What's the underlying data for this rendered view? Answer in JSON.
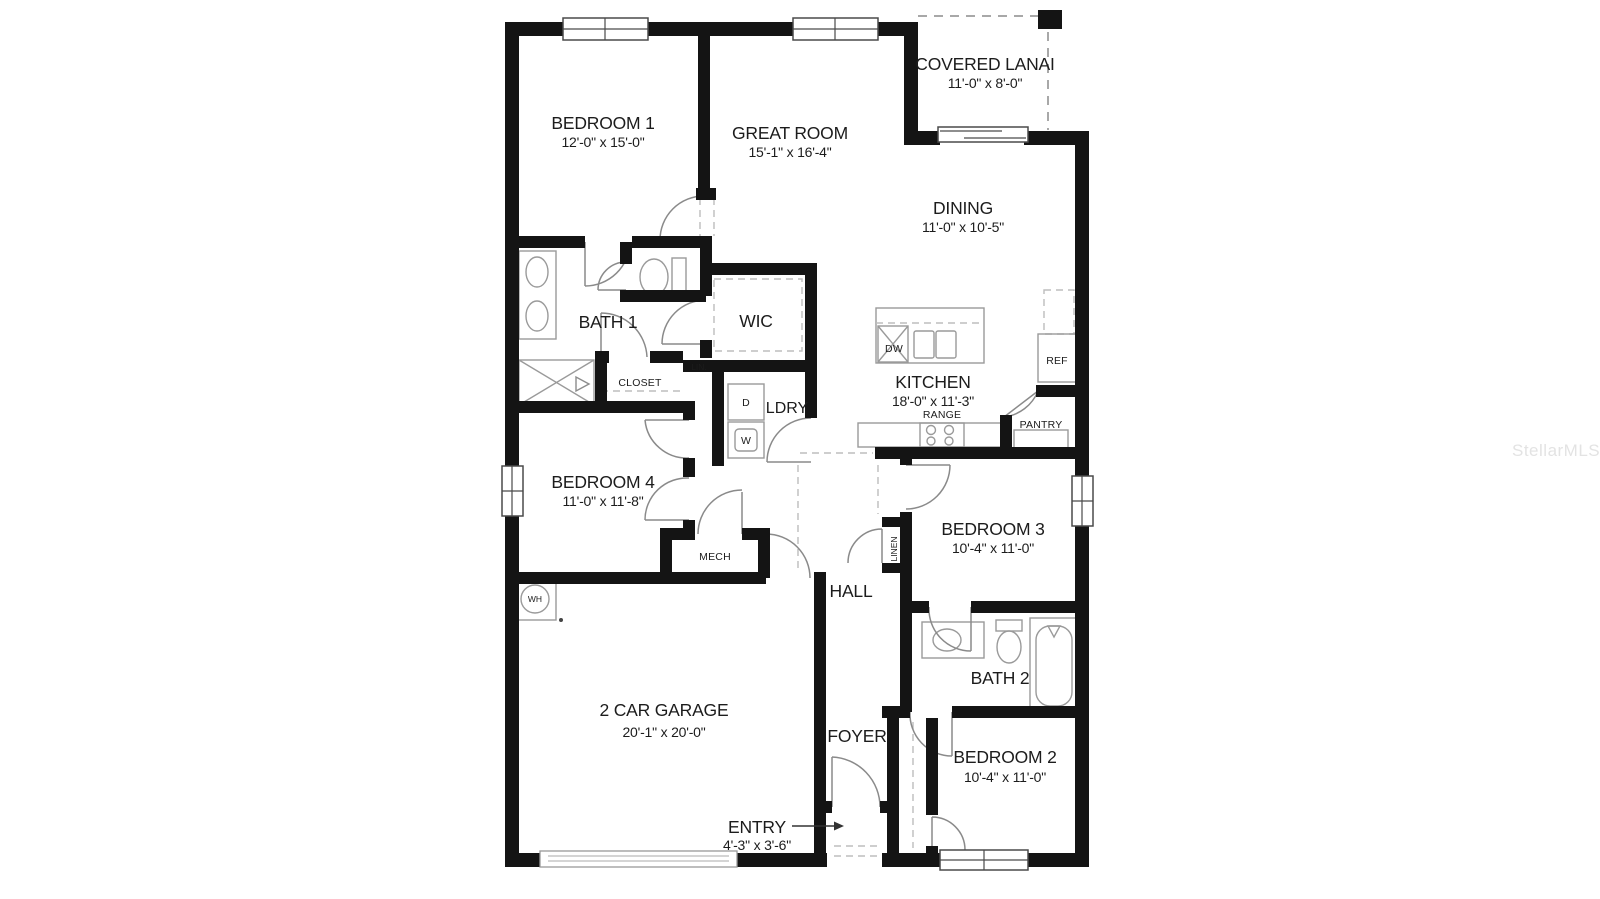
{
  "watermark": "StellarMLS",
  "rooms": {
    "bedroom1": {
      "name": "BEDROOM 1",
      "dims": "12'-0\" x 15'-0\""
    },
    "great_room": {
      "name": "GREAT ROOM",
      "dims": "15'-1\" x 16'-4\""
    },
    "covered_lanai": {
      "name": "COVERED LANAI",
      "dims": "11'-0\" x 8'-0\""
    },
    "dining": {
      "name": "DINING",
      "dims": "11'-0\" x 10'-5\""
    },
    "kitchen": {
      "name": "KITCHEN",
      "dims": "18'-0\" x 11'-3\""
    },
    "bath1": {
      "name": "BATH 1"
    },
    "wic": {
      "name": "WIC"
    },
    "closet": {
      "name": "CLOSET"
    },
    "lin": {
      "name": "LIN."
    },
    "ldry": {
      "name": "LDRY"
    },
    "bedroom4": {
      "name": "BEDROOM 4",
      "dims": "11'-0\" x 11'-8\""
    },
    "mech": {
      "name": "MECH"
    },
    "wh": {
      "name": "WH"
    },
    "hall": {
      "name": "HALL"
    },
    "linen": {
      "name": "LINEN"
    },
    "bedroom3": {
      "name": "BEDROOM 3",
      "dims": "10'-4\" x 11'-0\""
    },
    "bath2": {
      "name": "BATH 2"
    },
    "pantry": {
      "name": "PANTRY"
    },
    "garage": {
      "name": "2 CAR GARAGE",
      "dims": "20'-1\" x 20'-0\""
    },
    "foyer": {
      "name": "FOYER"
    },
    "bedroom2": {
      "name": "BEDROOM 2",
      "dims": "10'-4\" x 11'-0\""
    },
    "entry": {
      "name": "ENTRY",
      "dims": "4'-3\" x 3'-6\""
    }
  },
  "appliances": {
    "dw": "DW",
    "ref": "REF",
    "range": "RANGE",
    "dryer": "D",
    "washer": "W"
  },
  "colors": {
    "wall": "#141414",
    "fixture": "#9a9a9a",
    "text": "#1c1c1c",
    "watermark": "#e3e3e3"
  }
}
